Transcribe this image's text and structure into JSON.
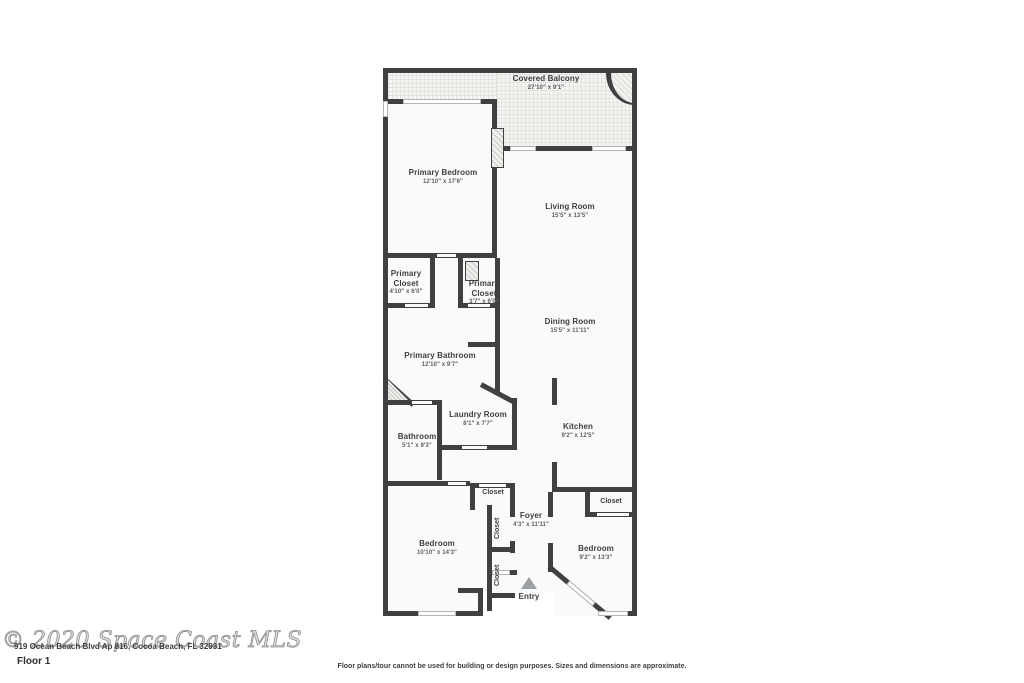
{
  "page": {
    "watermark": "© 2020 Space Coast MLS",
    "address": "919 Ocean Beach Blvd Ap 816, Cocoa Beach, FL 32931",
    "floor_label": "Floor 1",
    "disclaimer": "Floor plans/tour cannot be used for building or design purposes. Sizes and dimensions are approximate."
  },
  "floorplan": {
    "entry_label": "Entry",
    "closet_label": "Closet",
    "rooms": [
      {
        "id": "covered-balcony",
        "name": "Covered Balcony",
        "dims": "27'10\" x 9'1\""
      },
      {
        "id": "primary-bedroom",
        "name": "Primary Bedroom",
        "dims": "12'10\" x 17'6\""
      },
      {
        "id": "living-room",
        "name": "Living Room",
        "dims": "15'5\" x 13'5\""
      },
      {
        "id": "primary-closet-1",
        "name": "Primary Closet",
        "dims": "4'10\" x 6'0\""
      },
      {
        "id": "primary-closet-2",
        "name": "Primary Closet",
        "dims": "3'7\" x 6'0\""
      },
      {
        "id": "dining-room",
        "name": "Dining Room",
        "dims": "15'5\" x 11'11\""
      },
      {
        "id": "primary-bathroom",
        "name": "Primary Bathroom",
        "dims": "12'10\" x 9'7\""
      },
      {
        "id": "laundry-room",
        "name": "Laundry Room",
        "dims": "8'1\" x 7'7\""
      },
      {
        "id": "bathroom",
        "name": "Bathroom",
        "dims": "5'1\" x 9'3\""
      },
      {
        "id": "kitchen",
        "name": "Kitchen",
        "dims": "9'2\" x 12'5\""
      },
      {
        "id": "foyer",
        "name": "Foyer",
        "dims": "4'3\" x 11'11\""
      },
      {
        "id": "bedroom-left",
        "name": "Bedroom",
        "dims": "10'10\" x 14'3\""
      },
      {
        "id": "bedroom-right",
        "name": "Bedroom",
        "dims": "9'2\" x 13'3\""
      }
    ],
    "colors": {
      "wall": "#3f4042",
      "room_fill": "#fafafa",
      "label_text": "#3d3e42",
      "dim_text": "#5c5d60",
      "entry_arrow": "#9aa0a4"
    }
  }
}
